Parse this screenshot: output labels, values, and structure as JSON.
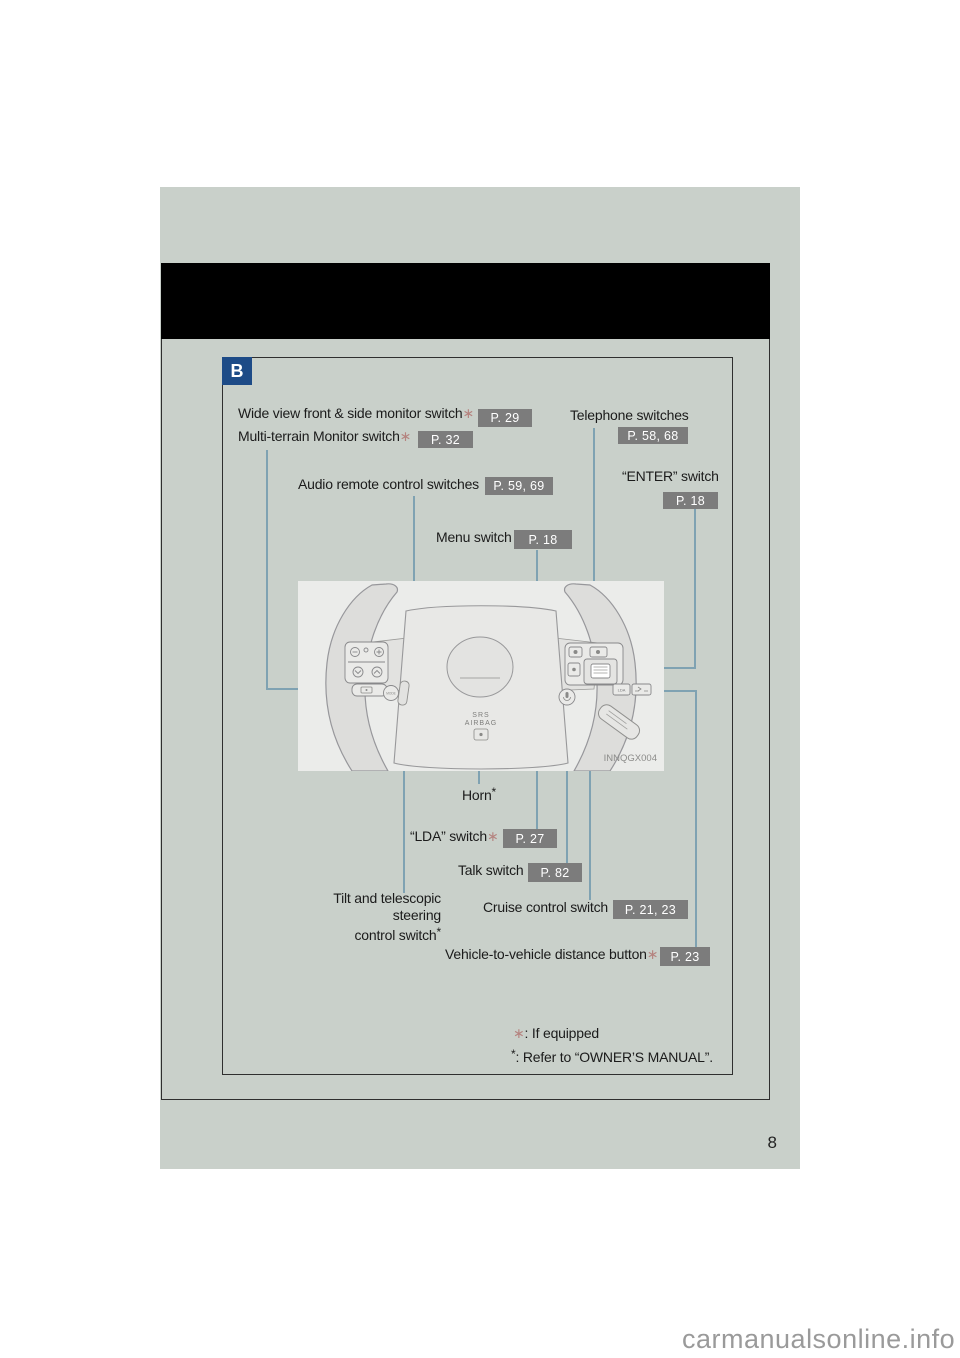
{
  "tab": "B",
  "callouts": {
    "wide_view": {
      "label": "Wide view front & side monitor switch",
      "asterisk": "∗",
      "ref": "P. 29"
    },
    "multi_terrain": {
      "label": "Multi-terrain Monitor switch",
      "asterisk": "∗",
      "ref": "P. 32"
    },
    "telephone": {
      "label": "Telephone switches",
      "ref": "P. 58, 68"
    },
    "enter": {
      "label": "“ENTER” switch",
      "ref": "P. 18"
    },
    "audio": {
      "label": "Audio remote control switches",
      "ref": "P. 59, 69"
    },
    "menu": {
      "label": "Menu switch",
      "ref": "P. 18"
    },
    "horn": {
      "label": "Horn",
      "star": "*"
    },
    "lda": {
      "label": "“LDA” switch",
      "asterisk": "∗",
      "ref": "P. 27"
    },
    "talk": {
      "label": "Talk switch",
      "ref": "P. 82"
    },
    "tilt": {
      "line1": "Tilt and telescopic steering",
      "line2": "control switch",
      "star": "*"
    },
    "cruise": {
      "label": "Cruise control switch",
      "ref": "P. 21, 23"
    },
    "vehicle_distance": {
      "label": "Vehicle-to-vehicle distance button",
      "asterisk": "∗",
      "ref": "P. 23"
    }
  },
  "footnotes": {
    "if_equipped": {
      "symbol": "∗",
      "text": ": If equipped"
    },
    "owners_manual": {
      "symbol": "*",
      "text": ": Refer to “OWNER’S MANUAL”."
    }
  },
  "wheel_diagram": {
    "srs_line1": "SRS",
    "srs_line2": "AIRBAG",
    "image_code": "INNQGX004"
  },
  "page_number": "8",
  "watermark": "carmanualsonline.info",
  "colors": {
    "page_background": "#ffffff",
    "panel_sage": "#c9d0ca",
    "banner_black": "#000000",
    "tab_blue": "#1d4b87",
    "ref_box_gray": "#7c7c7c",
    "leader_blue": "#7fa2b2",
    "asterisk_pink": "#b5837f",
    "figure_background": "#ebecea"
  }
}
